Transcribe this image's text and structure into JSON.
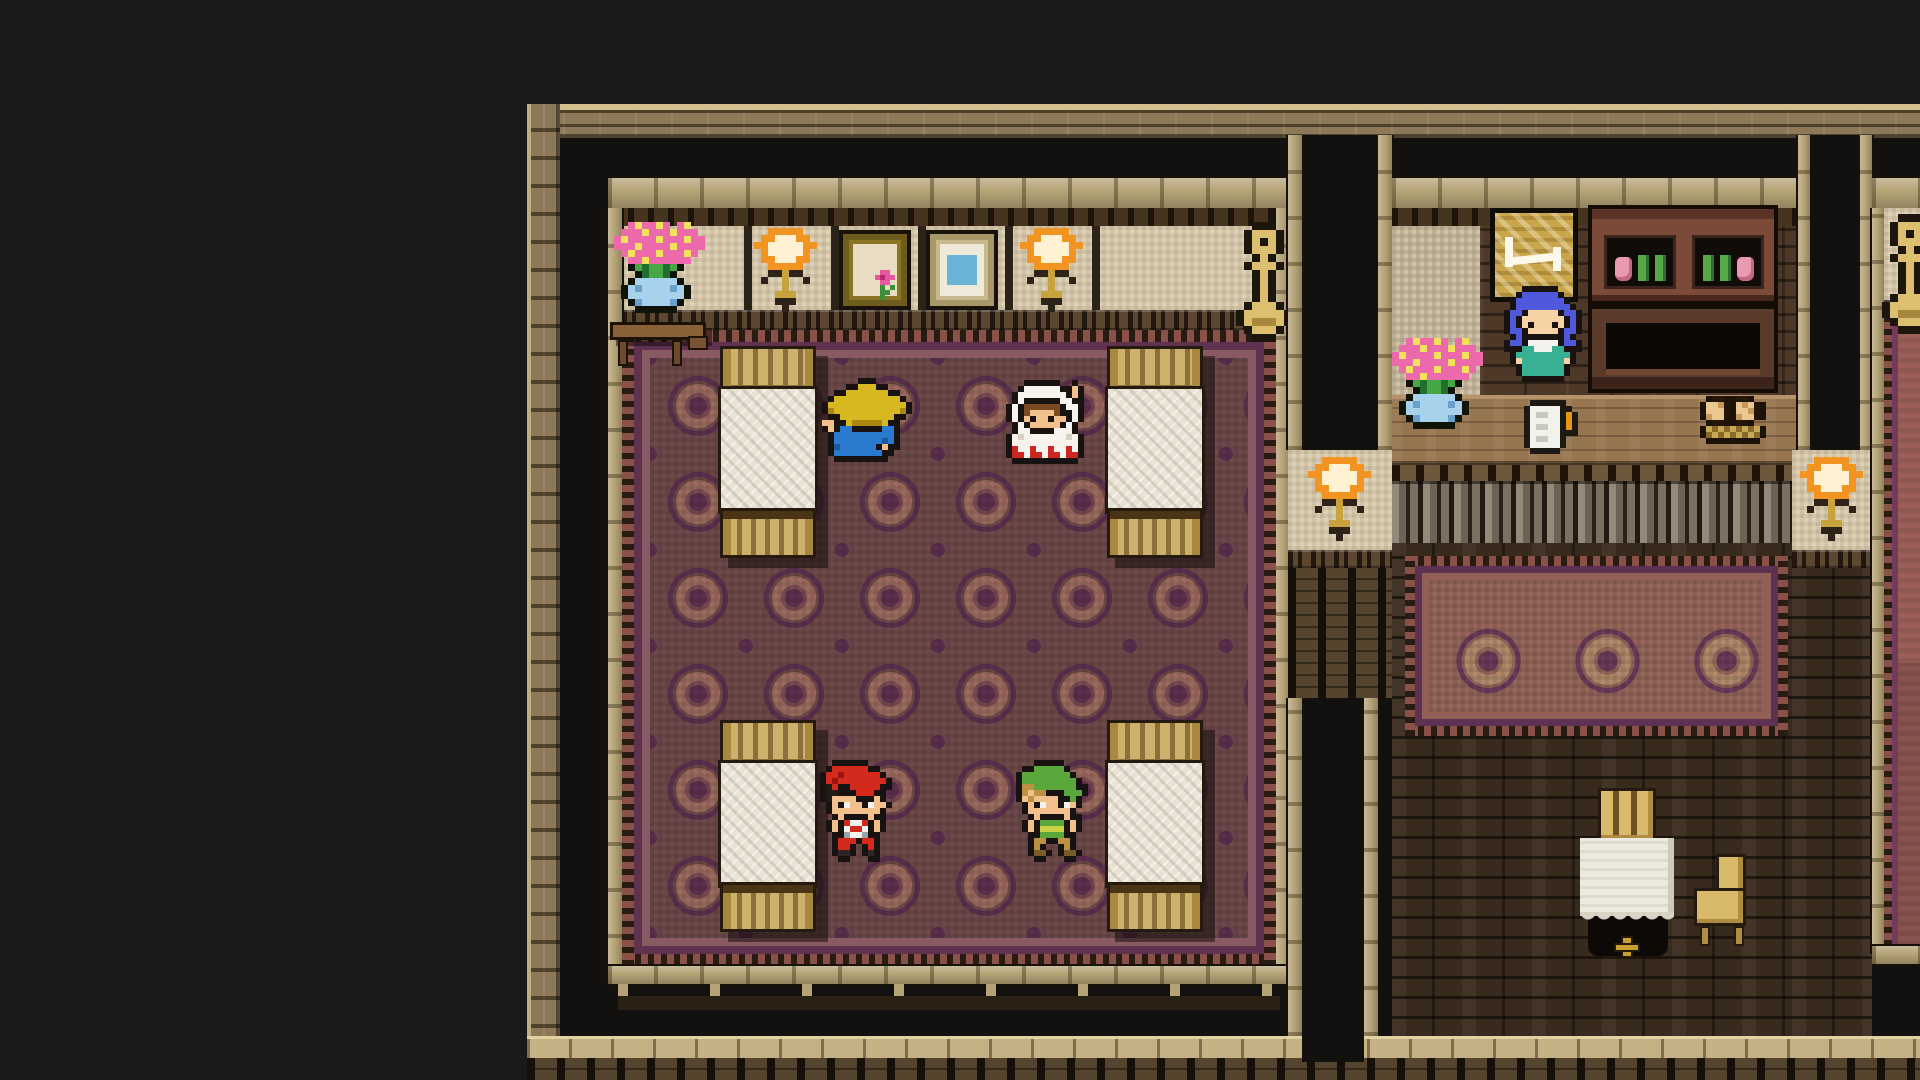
{
  "meta": {
    "scene_label": "16-bit RPG inn interior, overhead view",
    "rooms": {
      "bedroom": "Inn bedroom with four beds and patterned carpet",
      "lobby": "Innkeeper counter room with wooden floor and rug",
      "east_room": "Partially visible room at far right edge"
    }
  },
  "palette": {
    "void_black": "#131110",
    "outer_wall_tan": "#8d7957",
    "beam_beige": "#b5a376",
    "wall_cream": "#ddd1b6",
    "carpet_maroon": "#6d4949",
    "carpet_purple": "#5c2f4e",
    "carpet_rose": "#9c6a5e",
    "wood_dark": "#4e3928",
    "counter_brown": "#97754f",
    "lamp_orange": "#f29422",
    "sign_gold": "#c9a64b"
  },
  "entities": [
    {
      "id": "traveler-straw-hat",
      "label": "Sleeping traveler in straw hat and blue robe"
    },
    {
      "id": "white-mage",
      "label": "White-robed mage with red trim"
    },
    {
      "id": "boy-red-cap",
      "label": "Boy in red cap and striped shirt"
    },
    {
      "id": "boy-green-tunic",
      "label": "Boy in green tunic and cap"
    },
    {
      "id": "innkeeper",
      "label": "Blue-haired innkeeper in teal dress"
    }
  ],
  "objects": [
    {
      "id": "bed",
      "label": "Inn bed",
      "count": 4
    },
    {
      "id": "wall-lamp",
      "label": "Wall torch sconce",
      "count": 4
    },
    {
      "id": "framed-flower-picture",
      "label": "Framed flower picture"
    },
    {
      "id": "framed-blue-picture",
      "label": "Framed blue picture"
    },
    {
      "id": "flower-shelf",
      "label": "Corner shelf with flower pot"
    },
    {
      "id": "candelabra",
      "label": "Gold candelabra stand",
      "count": 2
    },
    {
      "id": "inn-sign",
      "label": "Gold inn sign with bed symbol"
    },
    {
      "id": "cabinet",
      "label": "Cabinet with potions and bottles"
    },
    {
      "id": "counter",
      "label": "Wooden inn counter"
    },
    {
      "id": "flower-bouquet",
      "label": "Pink bouquet in blue bowl"
    },
    {
      "id": "guest-ledger",
      "label": "Paper with candle on counter"
    },
    {
      "id": "bread-basket",
      "label": "Basket with bread loaves"
    },
    {
      "id": "cloth-table",
      "label": "Table with white tablecloth"
    },
    {
      "id": "wooden-chair",
      "label": "Wooden chair",
      "count": 2
    }
  ],
  "sprites": {
    "ness": {
      "px": 6,
      "palette": {
        "K": "#181210",
        "R": "#d42a1e",
        "D": "#9c1410",
        "A": "#201a14",
        "S": "#f2c08c",
        "W": "#f4f2ee",
        "G": "#9ba2a8",
        "B": "#2c2624"
      },
      "rows": [
        "..KKKKKK......",
        ".KRRRRRRKK....",
        "KRRDRRRRRRK...",
        "KRDRRRRRRRRK..",
        "KARKKRRRRRKK..",
        "KAAKKKRRRKK...",
        "KASSSSKKKSK...",
        ".KSKWSSKWSSK..",
        ".KSSSSSSSSK...",
        "..KSKKKKSKK...",
        ".KSKRWWRKSK...",
        ".KSKWRRWKSK...",
        "..KKGWWGKK....",
        "..KRRRKRRK....",
        "..KRRK.KRK....",
        "..KBBK.KBK....",
        "...KK...KK...."
      ]
    },
    "link": {
      "px": 6,
      "palette": {
        "K": "#181210",
        "G": "#5aa83c",
        "g": "#417e28",
        "Y": "#c8d244",
        "H": "#bc9242",
        "S": "#f2c08c",
        "W": "#f4f2ee",
        "B": "#7a5c28"
      },
      "rows": [
        "...KKKKK......",
        ".KKGGGGGK.....",
        "KGGGGGGGGK....",
        "KGGGGGGGGGK...",
        "KHHGGGGGGGKK..",
        "KHSHHKKKGGGK..",
        "KSHSSSSKKGK...",
        ".KSKWSSKWSK...",
        ".KSSSSSSSK....",
        "..KSKKKKSKK...",
        ".KSKGGGGKSK...",
        ".KSKYYYYKSK...",
        "..KKGGGGKK....",
        "..KHHKKHHK....",
        "..KHK..KHK....",
        "..KBBK.KBBK...",
        "...KK...KK...."
      ]
    },
    "white_mage": {
      "px": 6,
      "palette": {
        "K": "#181210",
        "W": "#f6f4ec",
        "w": "#d8d2c4",
        "R": "#cc2820",
        "H": "#7c4a20",
        "S": "#f2c08c"
      },
      "rows": [
        "...KKKKKK..K..",
        "..KWWWWWWKKSK.",
        ".KWWWWWWWWKSK.",
        ".KWKKKKKKWWKK.",
        "KWKHHHHHHKWWK.",
        "KWKHSSSSHKKWK.",
        "KWKSKSSKSSKWK.",
        ".KWKSSSSSKWK..",
        ".KWWKKKKWWWK..",
        "KWwWWWWWWWwWK.",
        "KWWWWWWWWWWWK.",
        "KRWWRWWRWWRWK.",
        "KRRWRRWRRWRRK.",
        ".KKKKKKKKKKK.."
      ]
    },
    "straw_mage": {
      "px": 6,
      "palette": {
        "K": "#181210",
        "Y": "#d8b820",
        "y": "#a8880e",
        "B": "#2a7ad0",
        "b": "#1c5aa0",
        "S": "#f2c08c"
      },
      "rows": [
        "......KKK......",
        "....KKYYYKK....",
        "..KKYYYYYYYKK..",
        ".KYYYYYYYYYYYK.",
        "KYYYYYYYYYYYYYK",
        "KyYYYYYYYYYYYyK",
        ".KKYYYYYYYYYKK.",
        "SSKKYyyyyyYKK..",
        "KSKBBKKKKKBBK..",
        ".KBBBBBBBBBBK..",
        ".KBBBBBBBBbBK..",
        ".KbBBBBBBKSKK..",
        ".KBBBBBBBBKK...",
        "..KKKKKKKKK...."
      ]
    },
    "innkeeper": {
      "px": 6,
      "palette": {
        "K": "#181210",
        "U": "#5058dc",
        "u": "#3038b0",
        "S": "#f6d2a4",
        "T": "#38b094",
        "t": "#207a64",
        "W": "#f4f2ee"
      },
      "rows": [
        "...KKKKKK.....",
        "..KUUUUUUK....",
        ".KUUUUUUUUK...",
        ".KUUUUUUUUUK..",
        "KUUKSSSSSKUUK.",
        "KUKSSSSSSSKUK.",
        "KUKSKSSSKSKUK.",
        "KUUKSSSSSKUUK.",
        ".KUKKKKKKKUK..",
        "KUUKWWWWWKUUK.",
        "KKKTTWWWTTKKK.",
        ".KTTTTTTTTTK..",
        ".KSTTTTTTTSK..",
        "..KTTTTTTTK...",
        "..KTTTTTTTK...",
        "...KKKKKKK...."
      ]
    },
    "torch": {
      "px": 7,
      "palette": {
        "O": "#f29422",
        "W": "#fef2d2",
        "G": "#c8a23c",
        "D": "#2e2318"
      },
      "rows": [
        "..OOOOO..",
        ".OOWWWOO.",
        "OOWWWWWOO",
        ".OWWWWWO.",
        ".OOWWWOO.",
        "..OOOOO..",
        "..DDGDD..",
        ".D..G..D.",
        "....G....",
        "...GGG...",
        "...DDD...",
        "....D...."
      ]
    },
    "candelabra": {
      "px": 8,
      "palette": {
        "K": "#1c160c",
        "G": "#dcc070",
        "g": "#a8883c"
      },
      "rows": [
        "..KKK..",
        ".KGGGK.",
        ".KGKGK.",
        ".KGGGK.",
        "..KGK..",
        ".KGGGK.",
        "..KGK..",
        "..KGK..",
        "..KGK..",
        "..KGK..",
        ".KGGGK.",
        "KGGGGGK",
        "KGgggGK",
        ".KGGGK.",
        "..KKK.."
      ]
    },
    "bouquet": {
      "px": 7,
      "palette": {
        "P": "#ec6aac",
        "p": "#c2367e",
        "Y": "#f2e25a",
        "G": "#46a844",
        "g": "#206e30",
        "B": "#a8d2ec",
        "b": "#6aa0cc",
        "K": "#101408"
      },
      "rows": [
        "..PYPPYP.PY...",
        ".PPPYPPPYPPP..",
        "PYPPPPYPPPYPP.",
        "PPPYPPPPYPPPP.",
        ".PYPPPYPPPYP..",
        "..PPYPPPPPP...",
        "..KGgGGgGK....",
        "...KgGGgK.....",
        "..KBBBBBBK....",
        ".KBbBBBBbBK...",
        ".KBBBBBBBBK...",
        "..KbBBBBbK....",
        "...KKKKKK....."
      ]
    },
    "basket": {
      "px": 6,
      "palette": {
        "K": "#1c1208",
        "T": "#ecc890",
        "t": "#c89858",
        "D": "#241606",
        "B": "#c8a850",
        "b": "#8a6a2a"
      },
      "rows": [
        ".KDDKKDDK..",
        "KTTtDKTtTDK",
        "KTTTDKTTtDK",
        "KtTTDKtTTDK",
        ".KDDKKDDK..",
        "KBbBbBbBbBK",
        "KbBbBbBbBbK",
        ".KKKKKKKKK."
      ]
    },
    "paper": {
      "px": 6,
      "palette": {
        "K": "#1c1812",
        "W": "#f2f2ec",
        "w": "#c8c8be",
        "O": "#e89418"
      },
      "rows": [
        ".KKKKKK..",
        "KWWWWWKK.",
        "KWwwWWKOK",
        "KWWWWWKOK",
        "KWwwWWKOK",
        "KWWWWWKKK",
        "KWwwWWK..",
        "KWWWWWK..",
        ".KKKKK..."
      ]
    },
    "flower_motif": {
      "px": 5,
      "palette": {
        "P": "#e858a0",
        "p": "#b82a6e",
        "G": "#3e9038"
      },
      "rows": [
        ".PP..",
        "PpPP.",
        ".PP..",
        ".G.G.",
        ".GG..",
        ".G..."
      ]
    }
  }
}
